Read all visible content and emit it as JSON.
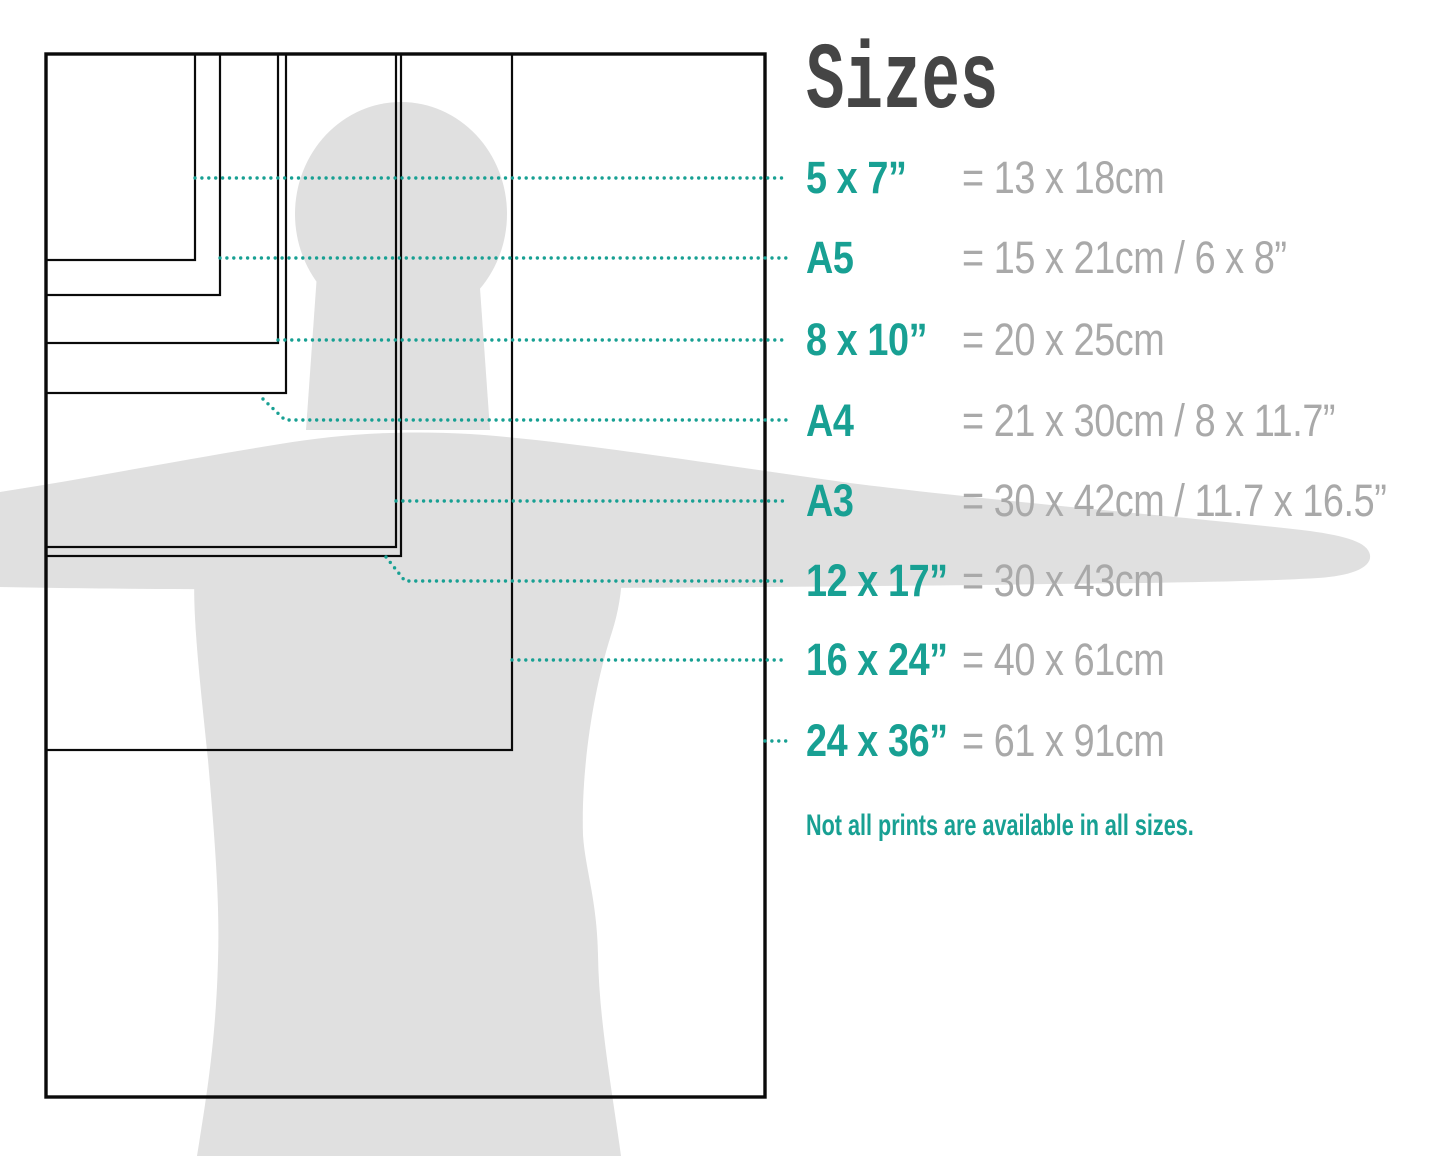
{
  "title": "Sizes",
  "note": "Not all prints are available in all sizes.",
  "rows": [
    {
      "label": "5 x 7”",
      "value": "= 13 x 18cm"
    },
    {
      "label": "A5",
      "value": "= 15 x 21cm / 6 x 8”"
    },
    {
      "label": "8 x 10”",
      "value": "= 20 x 25cm"
    },
    {
      "label": "A4",
      "value": "= 21 x 30cm / 8 x 11.7”"
    },
    {
      "label": "A3",
      "value": "= 30 x 42cm / 11.7 x 16.5”"
    },
    {
      "label": "12 x 17”",
      "value": "= 30 x 43cm"
    },
    {
      "label": "16 x 24”",
      "value": "= 40 x 61cm"
    },
    {
      "label": "24 x 36”",
      "value": "= 61 x 91cm"
    }
  ],
  "colors": {
    "teal": "#18a093",
    "value-gray": "#a9a9a9",
    "title-gray": "#454545",
    "silhouette": "#e0e0e0",
    "line-black": "#0a0a0a",
    "background": "#ffffff"
  }
}
